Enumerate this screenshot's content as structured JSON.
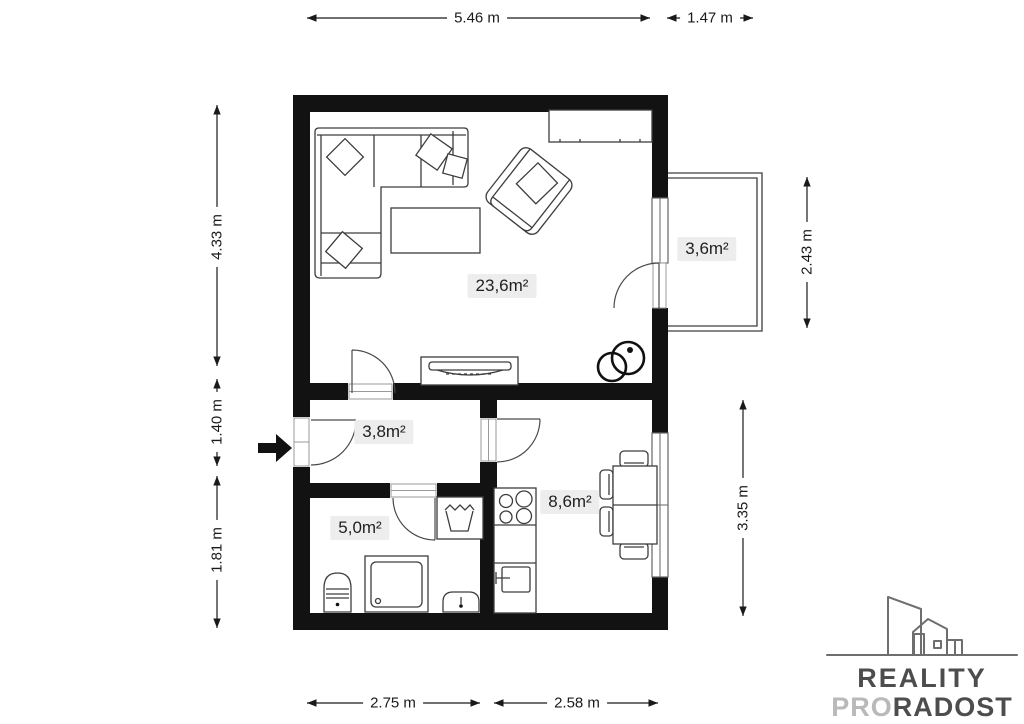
{
  "plan": {
    "rooms": [
      {
        "name": "living-room",
        "area": "23,6m²"
      },
      {
        "name": "balcony",
        "area": "3,6m²"
      },
      {
        "name": "hallway",
        "area": "3,8m²"
      },
      {
        "name": "bathroom",
        "area": "5,0m²"
      },
      {
        "name": "kitchen",
        "area": "8,6m²"
      }
    ],
    "dimensions": {
      "top": [
        "5.46 m",
        "1.47 m"
      ],
      "left": [
        "4.33 m",
        "1.40 m",
        "1.81 m"
      ],
      "right": [
        "2.43 m",
        "3.35 m"
      ],
      "bottom": [
        "2.75 m",
        "2.58 m"
      ]
    }
  },
  "logo": {
    "line1": "REALITY",
    "line2_light": "PRO",
    "line2_dark": "RADOST"
  },
  "colors": {
    "wall": "#121212",
    "furniture_line": "#3d3d3d",
    "label_bg": "#ededed",
    "label_text": "#1f1f1f",
    "logo_dark": "#4d4d4d",
    "logo_light": "#b9b9b9",
    "logo_building": "#6e6e6e"
  }
}
